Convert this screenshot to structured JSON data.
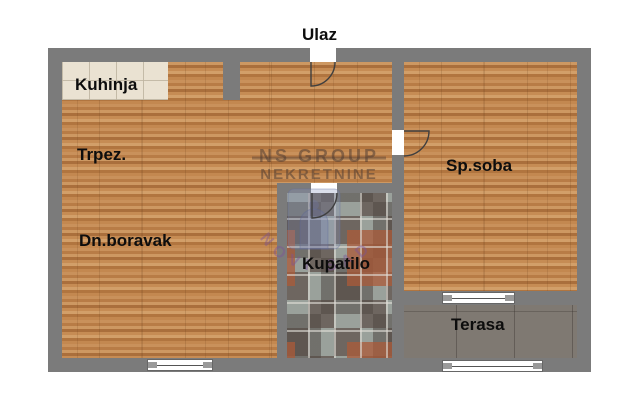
{
  "plan": {
    "title_label": "Ulaz",
    "rooms": {
      "kitchen": "Kuhinja",
      "dining": "Trpez.",
      "living": "Dn.boravak",
      "bathroom": "Kupatilo",
      "bedroom": "Sp.soba",
      "terrace": "Terasa"
    },
    "watermark": {
      "line1": "NS GROUP",
      "line2": "NEKRETNINE",
      "arc_text": "NOVI SAD"
    },
    "colors": {
      "wall": "#7b7b7b",
      "wood_floor": "#c18a55",
      "kitchen_tile": "#eae2d2",
      "bath_tile_dark": "#6e6660",
      "bath_tile_light": "#9aa19b",
      "bath_tile_accent": "#ab5a38",
      "terrace_tile": "#867f78",
      "watermark_text": "rgba(75,58,50,0.52)",
      "watermark_arc": "rgba(125,85,150,0.45)"
    }
  }
}
